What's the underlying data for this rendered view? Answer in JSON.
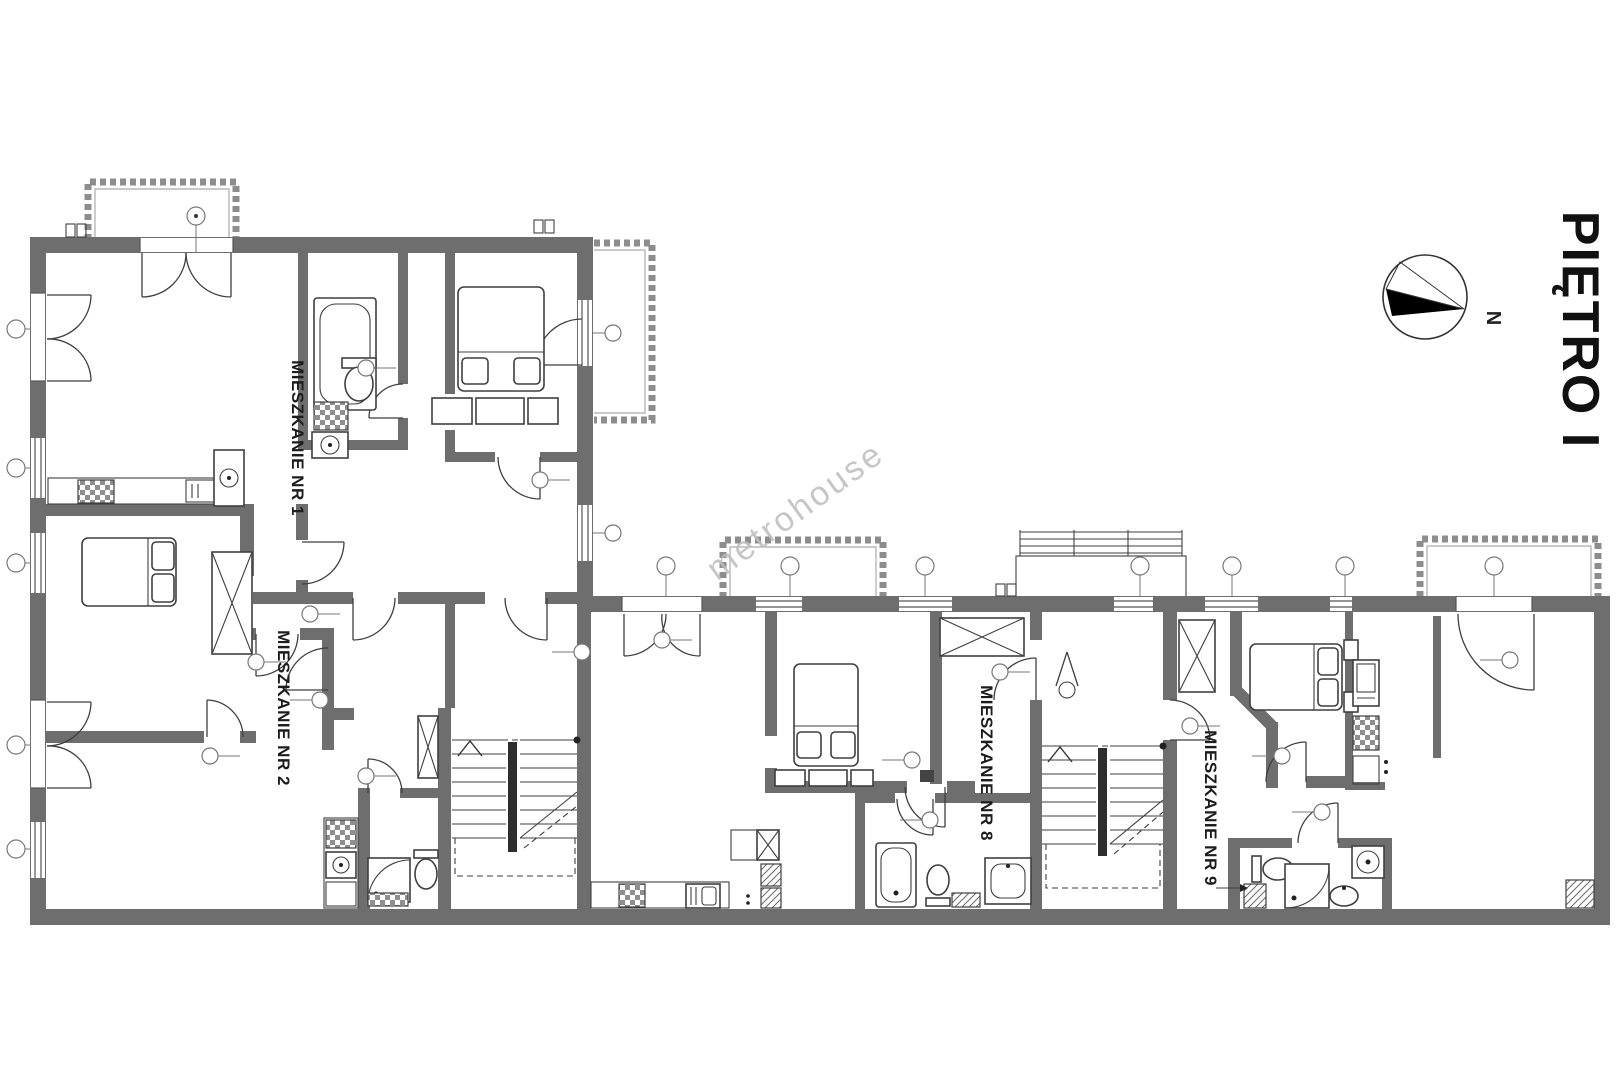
{
  "title": {
    "text": "PIĘTRO I"
  },
  "compass": {
    "label": "N"
  },
  "watermark": {
    "text": "metrohouse"
  },
  "apartments": [
    {
      "label": "MIESZKANIE NR 1"
    },
    {
      "label": "MIESZKANIE NR 2"
    },
    {
      "label": "MIESZKANIE NR 8"
    },
    {
      "label": "MIESZKANIE NR 9"
    }
  ],
  "colors": {
    "background": "#ffffff",
    "wall": "#6e6e6e",
    "line": "#3f3f3f",
    "thin": "#555555",
    "balcony": "#8d8d8d",
    "stair_rail": "#2e2e2e",
    "marker": "#777777",
    "watermark": "#bdbdbd",
    "label_text": "#1c1c1c"
  }
}
